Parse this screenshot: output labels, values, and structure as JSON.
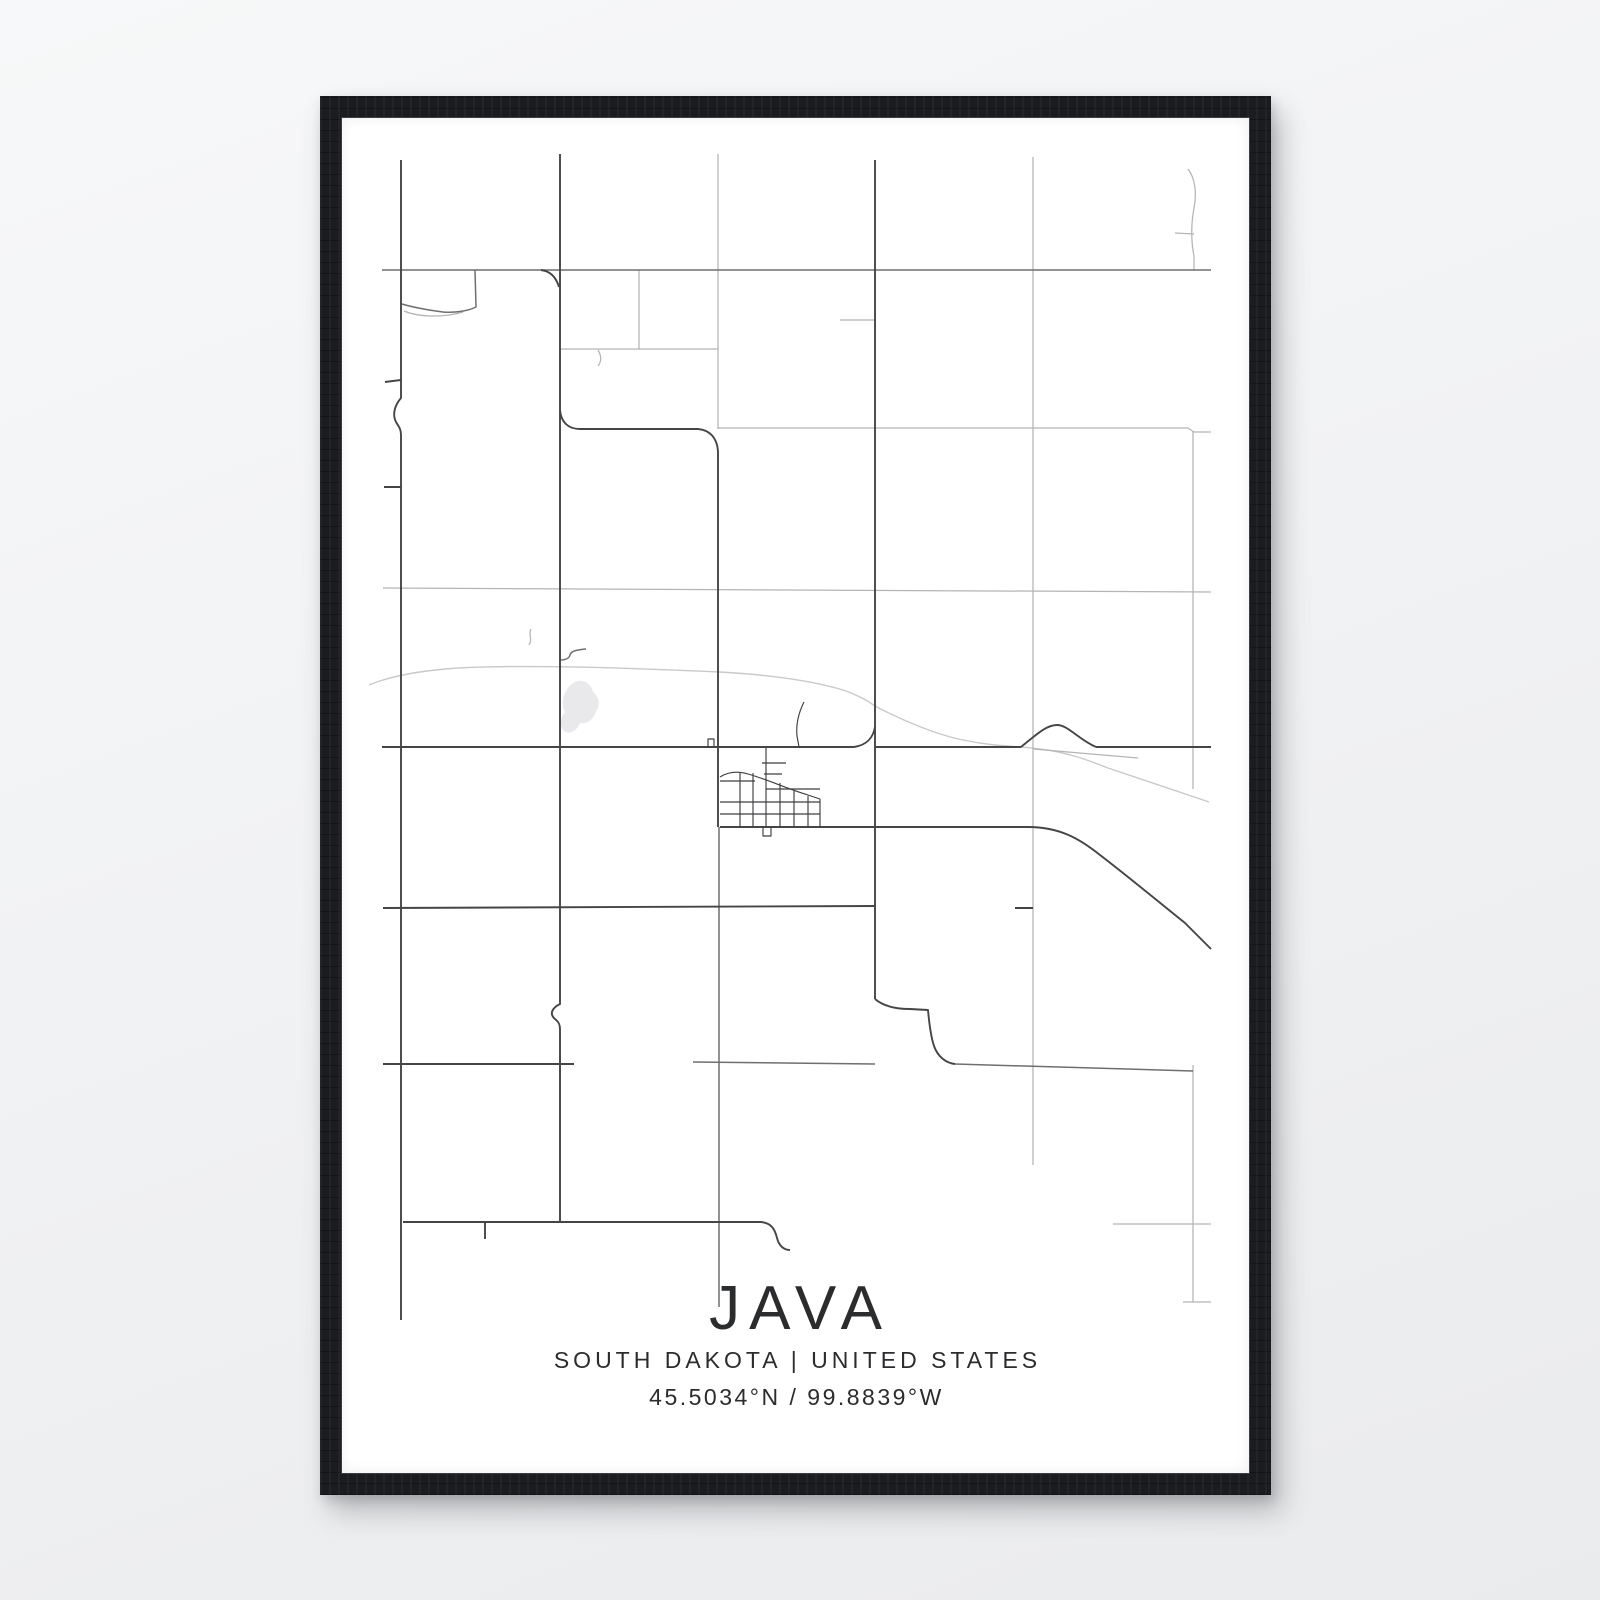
{
  "poster": {
    "title": "JAVA",
    "subtitle": "SOUTH DAKOTA | UNITED STATES",
    "coordinates": "45.5034°N / 99.8839°W"
  },
  "colors": {
    "background_top": "#f7f8f9",
    "background_bottom": "#eaebed",
    "frame": "#1b1c1f",
    "frame_lip": "#3d3e42",
    "paper": "#ffffff",
    "text": "#2b2c2e",
    "road_dark": "#454547",
    "road_medium": "#6f6f72",
    "road_light": "#b4b4b7",
    "railroad": "#c9c9cb",
    "town": "#3f3f41",
    "water": "#e9e9ec"
  },
  "map": {
    "viewBox": "344 116 907 1355",
    "water": [
      "M574,682 C582,675 593,680 595,690 C601,695 603,703 598,709 C596,717 589,723 582,721 C579,729 571,733 566,729 C561,724 562,716 567,710 C562,701 566,688 574,682 Z"
    ],
    "layers": [
      {
        "name": "railroad-line",
        "color": "railroad",
        "width": 1.4,
        "paths": [
          "M371,683 C395,673 430,668 460,666 C540,662 650,667 722,670 C775,673 815,679 845,688 C862,694 870,699 877,704 C905,719 940,733 965,738 C998,745 1022,744 1042,747 C1068,750 1090,758 1110,766 C1148,779 1182,790 1211,800"
        ]
      },
      {
        "name": "minor-road",
        "color": "road_light",
        "width": 1.25,
        "paths": [
          "M720,152 L720,427",
          "M641,268 L641,347",
          "M562,347 L720,347",
          "M600,348 C603,353 604,359 600,364",
          "M720,426 L1190,426 L1196,430 L1213,430",
          "M1035,155 L1035,1163",
          "M1195,429 L1195,787",
          "M1195,1063 L1195,1300",
          "M1185,1300 L1213,1300",
          "M385,586 L1213,590",
          "M1190,167 C1197,176 1199,191 1196,206 C1193,222 1193,240 1196,254 L1196,268",
          "M1177,231 L1196,232",
          "M842,318 L877,318",
          "M1035,747 L1140,756",
          "M1115,1222 L1213,1222",
          "M533,627 C530,633 535,637 531,643",
          "M406,309 C420,315 445,316 465,310"
        ]
      },
      {
        "name": "secondary-road",
        "color": "road_medium",
        "width": 1.5,
        "paths": [
          "M384,268 L1213,268",
          "M477,268 L478,305 C470,309 457,311 445,310 C430,308 414,305 404,302",
          "M695,1060 L877,1062",
          "M957,1062 L1195,1069",
          "M721,825 L721,1305",
          "M562,658 C567,658 571,657 572,653 C573,649 578,648 588,647"
        ]
      },
      {
        "name": "major-road",
        "color": "road_dark",
        "width": 1.9,
        "paths": [
          "M403,158 L403,396 C397,403 394,412 398,420 C401,425 403,427 403,433 L403,1318",
          "M387,380 L403,378",
          "M386,485 L403,485",
          "M562,152 L562,1002 C554,1006 551,1012 557,1017 C561,1020 562,1023 562,1027 L562,1220",
          "M543,268 C552,269 558,275 561,285",
          "M562,408 C563,420 570,427 582,427 L700,427 C712,428 719,436 720,449 L720,825",
          "M877,158 L877,997",
          "M856,745 C869,743 875,736 877,725",
          "M384,745 L856,745",
          "M877,745 L1023,745",
          "M1023,745 C1040,731 1049,723 1059,723 C1070,723 1080,737 1098,745",
          "M1098,745 L1213,745",
          "M722,825 L1030,825 C1062,825 1082,837 1102,853 C1132,876 1162,901 1187,921 L1213,947",
          "M385,906 L877,904",
          "M1017,906 L1035,906",
          "M385,1062 L576,1062",
          "M877,997 C884,1003 896,1007 912,1007 L930,1008 C931,1018 932,1032 936,1044 C940,1055 948,1061 957,1062",
          "M405,1220 L763,1220 C774,1221 777,1228 779,1236 C781,1244 786,1248 792,1248",
          "M487,1220 L487,1237"
        ]
      },
      {
        "name": "town-street",
        "color": "town",
        "width": 1.15,
        "paths": [
          "M722,775 C730,770 740,769 750,772 C768,777 790,787 810,793 L822,797",
          "M822,797 L822,825",
          "M742,770 L742,825",
          "M755,771 L755,825",
          "M768,746 L768,825",
          "M782,781 L782,825",
          "M796,789 L796,825",
          "M810,794 L810,825",
          "M722,779 L757,779",
          "M768,787 L822,787",
          "M722,800 L822,800",
          "M722,812 L822,812",
          "M764,761 L788,761",
          "M766,772 L784,772",
          "M806,700 C800,712 798,724 799,734 C800,740 801,744 801,746",
          "M765,825 L765,834 L773,834 L773,825",
          "M710,746 L710,737 L716,737 L716,746"
        ]
      }
    ]
  }
}
